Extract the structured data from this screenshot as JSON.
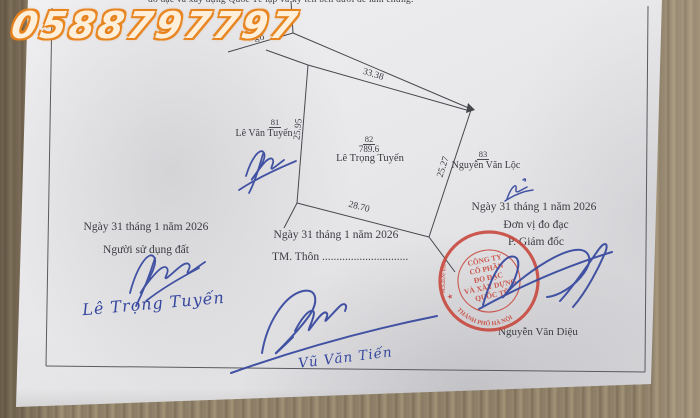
{
  "watermark": "0588797797",
  "top_text": "đo đạc và xây dựng Quốc Tế lập và ký tên bên dưới để làm chứng.",
  "colors": {
    "ink": "#3b3c42",
    "signature_blue": "#35479e",
    "stamp_red": "#c8453a",
    "watermark_orange": "#e8831c",
    "paper": "#e8e8ea",
    "wood": "#93846d"
  },
  "diagram": {
    "road_label": "Ngõ",
    "dimensions": {
      "top": "33.38",
      "left": "25.95",
      "bottom": "28.70",
      "right": "25.27"
    },
    "parcel": {
      "plot_number": "82",
      "area": "789.6",
      "owner": "Lê Trọng Tuyến"
    },
    "neighbor_left": {
      "plot_number": "81",
      "owner": "Lê Văn Tuyến"
    },
    "neighbor_right": {
      "plot_number": "83",
      "owner": "Nguyễn Văn Lộc"
    }
  },
  "signatures": {
    "land_user": {
      "date": "Ngày 31  tháng  1   năm 2026",
      "role": "Người sử dụng đất",
      "signed_name": "Lê Trọng Tuyến"
    },
    "hamlet": {
      "date": "Ngày 31 tháng 1 năm 2026",
      "role": "TM. Thôn ..............................",
      "signed_name": "Vũ Văn Tiến"
    },
    "surveyor": {
      "date": "Ngày  31  tháng  1   năm 2026",
      "unit": "Đơn vị đo đạc",
      "role": "P. Giám đốc",
      "name": "Nguyễn Văn Diệu"
    }
  },
  "stamp": {
    "center_lines": [
      "CÔNG TY",
      "CỔ PHẦN",
      "ĐO ĐẠC",
      "VÀ XÂY DỰNG",
      "QUỐC TẾ"
    ],
    "ring_left": "M.S.D.N: 0108",
    "ring_bottom": "THÀNH PHỐ HÀ NỘI",
    "star": "★"
  }
}
